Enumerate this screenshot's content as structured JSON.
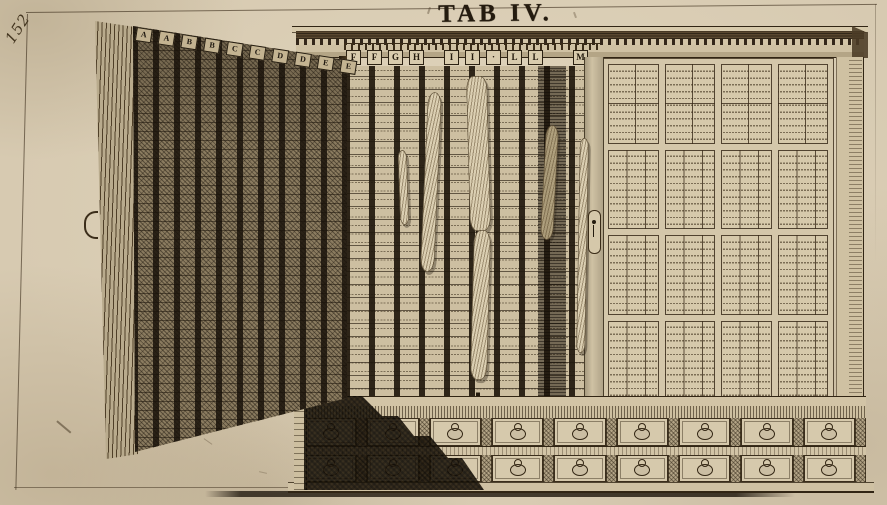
{
  "plate": {
    "title": "TAB IV.",
    "page_number": "152"
  },
  "cabinet": {
    "door_letters": [
      "A",
      "A",
      "B",
      "B",
      "C",
      "C",
      "D",
      "D",
      "E",
      "E"
    ],
    "interior_letters": [
      "F",
      "F",
      "G",
      "H",
      "I",
      "I",
      "·",
      "L",
      "L",
      "M"
    ]
  },
  "colors": {
    "paper": "#d7cab1",
    "ink": "#241b0f"
  }
}
